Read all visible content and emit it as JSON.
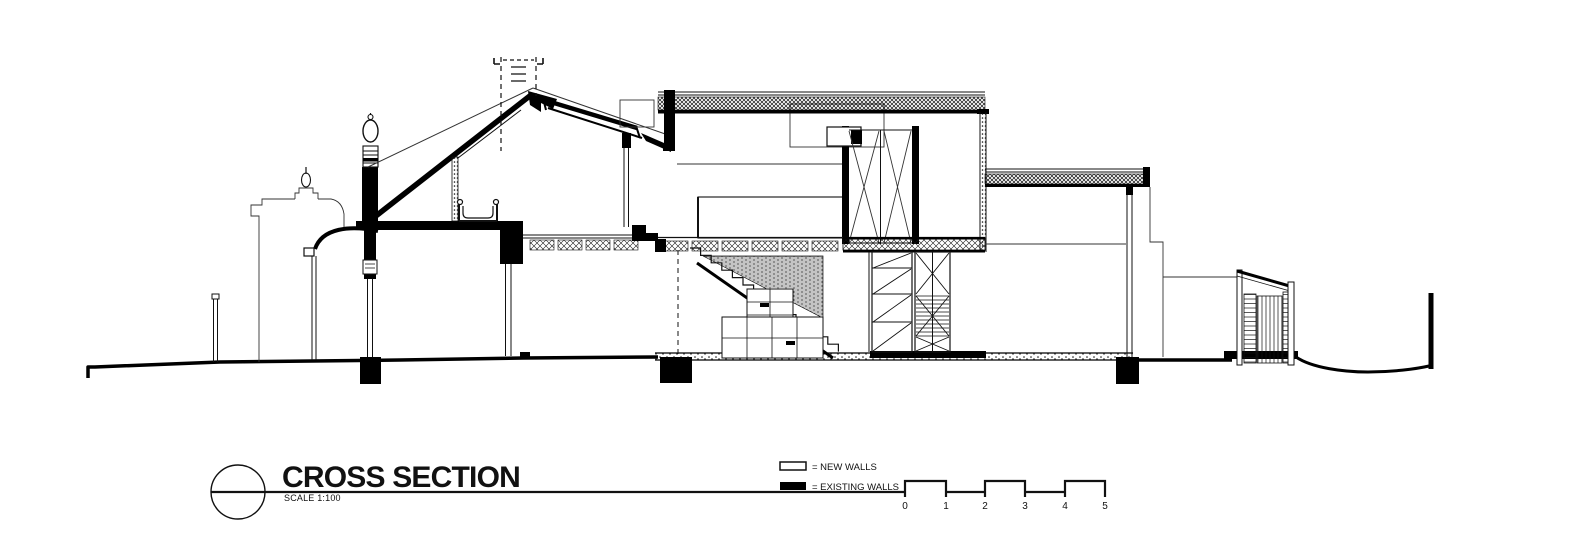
{
  "title_block": {
    "title": "CROSS SECTION",
    "scale_label": "SCALE 1:100"
  },
  "legend": {
    "items": [
      {
        "key": "new_walls",
        "label": "= NEW WALLS",
        "swatch_color": "#ffffff"
      },
      {
        "key": "existing_walls",
        "label": "= EXISTING WALLS",
        "swatch_color": "#000000"
      }
    ]
  },
  "scale_bar": {
    "unit_labels": [
      "0",
      "1",
      "2",
      "3",
      "4",
      "5"
    ]
  },
  "colors": {
    "ink": "#000000",
    "paper": "#ffffff"
  }
}
